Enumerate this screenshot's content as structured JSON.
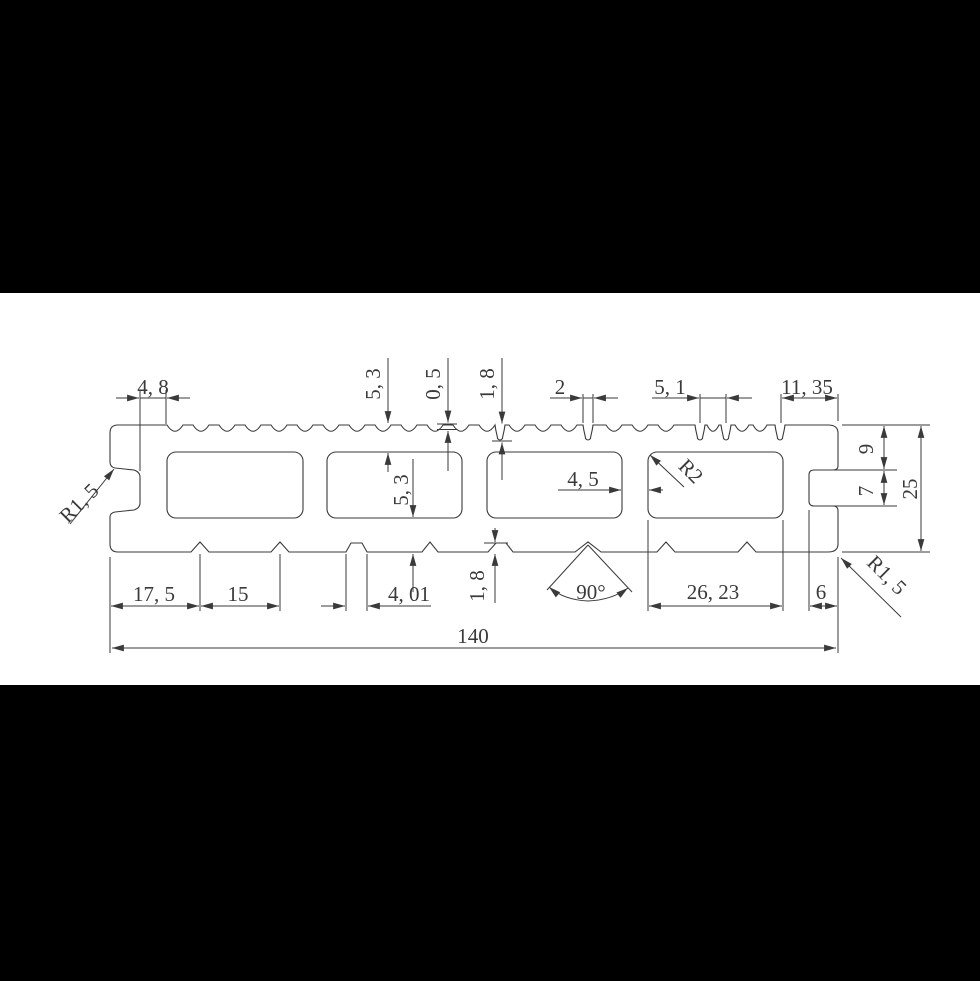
{
  "scene": {
    "background_color": "#000000",
    "paper_color": "#ffffff",
    "line_color": "#3a3a3a",
    "description": "Technical cross-section drawing of a hollow grooved decking board profile"
  },
  "dims": {
    "dim_4_8": "4, 8",
    "dim_5_3_top": "5, 3",
    "dim_0_5": "0, 5",
    "dim_1_8_top": "1, 8",
    "dim_2": "2",
    "dim_5_1": "5, 1",
    "dim_11_35": "11, 35",
    "dim_4_5": "4, 5",
    "dim_r2": "R2",
    "dim_9": "9",
    "dim_7": "7",
    "dim_25": "25",
    "dim_5_3_mid": "5, 3",
    "dim_17_5": "17, 5",
    "dim_15": "15",
    "dim_4_01": "4, 01",
    "dim_1_8_bottom": "1, 8",
    "dim_90": "90°",
    "dim_26_23": "26, 23",
    "dim_6": "6",
    "dim_140": "140",
    "dim_r1_5_left": "R1, 5",
    "dim_r1_5_right": "R1, 5"
  }
}
